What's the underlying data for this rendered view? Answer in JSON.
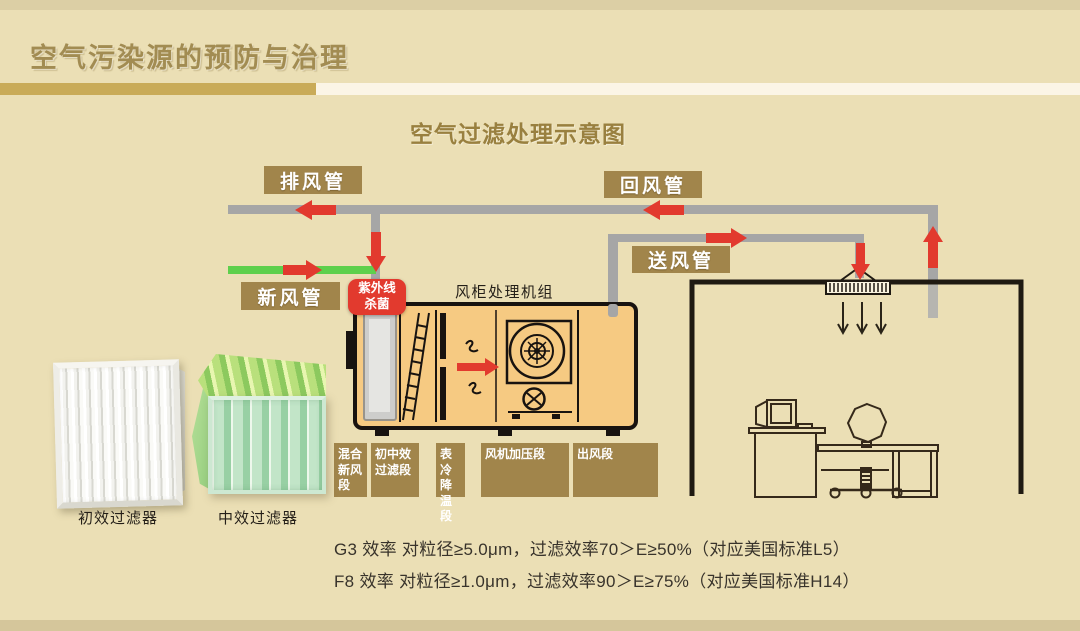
{
  "slide": {
    "title": "空气污染源的预防与治理",
    "subtitle": "空气过滤处理示意图"
  },
  "diagram": {
    "duct_labels": {
      "exhaust": "排风管",
      "return": "回风管",
      "supply": "送风管",
      "fresh": "新风管"
    },
    "uv_badge": {
      "line1": "紫外线",
      "line2": "杀菌"
    },
    "ahu_caption": "风柜处理机组",
    "sections": [
      "混合新风段",
      "初中效过滤段",
      "表冷降温段",
      "风机加压段",
      "出风段"
    ],
    "filter_captions": [
      "初效过滤器",
      "中效过滤器"
    ]
  },
  "notes": {
    "line1": "G3 效率 对粒径≥5.0μm，过滤效率70＞E≥50%（对应美国标准L5）",
    "line2": "F8 效率 对粒径≥1.0μm，过滤效率90＞E≥75%（对应美国标准H14）"
  },
  "colors": {
    "bg": "#ebdfb5",
    "bg_top_strip": "#dccfa5",
    "bg_bottom_strip": "#d5c69b",
    "title_gold": "#a28c52",
    "underline_gold": "#c9ab58",
    "underline_cream": "#fbf5e6",
    "label_gold": "#a1854b",
    "arrow_red": "#e23a2e",
    "duct_gray": "#a6a6a6",
    "fresh_air_green": "#5ed04c",
    "ahu_fill": "#f6ca82",
    "note_ink": "#38332b"
  }
}
